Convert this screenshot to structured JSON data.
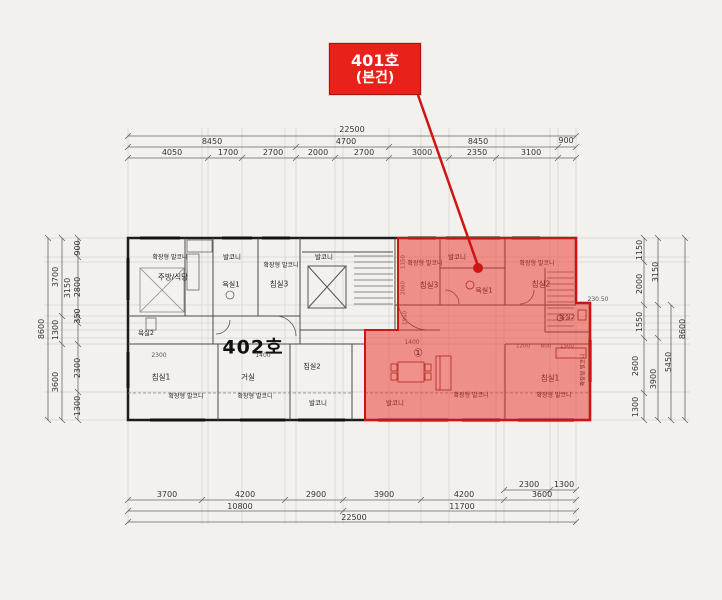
{
  "callout": {
    "line1": "401호",
    "line2": "(본건)"
  },
  "unit_label_402": "402호",
  "colors": {
    "callout_bg": "#e8211a",
    "overlay_fill": "rgba(235,45,35,0.5)",
    "overlay_stroke": "#cf1512",
    "leader_line": "#cf1512"
  },
  "dim_labels": [
    {
      "t": "22500",
      "x": 352,
      "y": 130
    },
    {
      "t": "8450",
      "x": 212,
      "y": 142
    },
    {
      "t": "4700",
      "x": 346,
      "y": 142
    },
    {
      "t": "8450",
      "x": 478,
      "y": 142
    },
    {
      "t": "900",
      "x": 566,
      "y": 141
    },
    {
      "t": "4050",
      "x": 172,
      "y": 153
    },
    {
      "t": "1700",
      "x": 228,
      "y": 153
    },
    {
      "t": "2700",
      "x": 273,
      "y": 153
    },
    {
      "t": "2000",
      "x": 318,
      "y": 153
    },
    {
      "t": "2700",
      "x": 364,
      "y": 153
    },
    {
      "t": "3000",
      "x": 422,
      "y": 153
    },
    {
      "t": "2350",
      "x": 477,
      "y": 153
    },
    {
      "t": "3100",
      "x": 531,
      "y": 153
    },
    {
      "t": "2300",
      "x": 529,
      "y": 485
    },
    {
      "t": "1300",
      "x": 564,
      "y": 485
    },
    {
      "t": "3700",
      "x": 167,
      "y": 495
    },
    {
      "t": "4200",
      "x": 245,
      "y": 495
    },
    {
      "t": "2900",
      "x": 316,
      "y": 495
    },
    {
      "t": "3900",
      "x": 384,
      "y": 495
    },
    {
      "t": "4200",
      "x": 464,
      "y": 495
    },
    {
      "t": "3600",
      "x": 542,
      "y": 495
    },
    {
      "t": "10800",
      "x": 240,
      "y": 507
    },
    {
      "t": "11700",
      "x": 462,
      "y": 507
    },
    {
      "t": "22500",
      "x": 354,
      "y": 518
    },
    {
      "t": "8600",
      "x": 42,
      "y": 329,
      "r": 1
    },
    {
      "t": "3700",
      "x": 56,
      "y": 277,
      "r": 1
    },
    {
      "t": "1300",
      "x": 56,
      "y": 330,
      "r": 1
    },
    {
      "t": "3600",
      "x": 56,
      "y": 382,
      "r": 1
    },
    {
      "t": "3150",
      "x": 68,
      "y": 288,
      "r": 1
    },
    {
      "t": "900",
      "x": 78,
      "y": 248,
      "r": 1
    },
    {
      "t": "2800",
      "x": 78,
      "y": 287,
      "r": 1
    },
    {
      "t": "350",
      "x": 78,
      "y": 316,
      "r": 1
    },
    {
      "t": "2300",
      "x": 78,
      "y": 368,
      "r": 1
    },
    {
      "t": "1300",
      "x": 78,
      "y": 406,
      "r": 1
    },
    {
      "t": "1150",
      "x": 640,
      "y": 250,
      "r": 1
    },
    {
      "t": "2000",
      "x": 640,
      "y": 284,
      "r": 1
    },
    {
      "t": "1550",
      "x": 640,
      "y": 322,
      "r": 1
    },
    {
      "t": "2600",
      "x": 636,
      "y": 366,
      "r": 1
    },
    {
      "t": "1300",
      "x": 636,
      "y": 407,
      "r": 1
    },
    {
      "t": "3150",
      "x": 656,
      "y": 272,
      "r": 1
    },
    {
      "t": "3900",
      "x": 654,
      "y": 379,
      "r": 1
    },
    {
      "t": "5450",
      "x": 669,
      "y": 362,
      "r": 1
    },
    {
      "t": "8600",
      "x": 683,
      "y": 329,
      "r": 1
    }
  ],
  "room_labels": [
    {
      "t": "확장형 발코니",
      "x": 170,
      "y": 258,
      "s": 6
    },
    {
      "t": "발코니",
      "x": 232,
      "y": 257,
      "s": 6.5
    },
    {
      "t": "주방/식당",
      "x": 173,
      "y": 277,
      "s": 7.5
    },
    {
      "t": "욕실1",
      "x": 231,
      "y": 285,
      "s": 7
    },
    {
      "t": "침실3",
      "x": 279,
      "y": 284,
      "s": 7.5
    },
    {
      "t": "확장형 발코니",
      "x": 281,
      "y": 266,
      "s": 6
    },
    {
      "t": "발코니",
      "x": 324,
      "y": 257,
      "s": 6.5
    },
    {
      "t": "욕실2",
      "x": 146,
      "y": 333,
      "s": 6.5
    },
    {
      "t": "침실1",
      "x": 161,
      "y": 377,
      "s": 7.5
    },
    {
      "t": "2300",
      "x": 159,
      "y": 356,
      "s": 6,
      "c": "#555"
    },
    {
      "t": "1400",
      "x": 263,
      "y": 356,
      "s": 6,
      "c": "#555"
    },
    {
      "t": "거실",
      "x": 248,
      "y": 377,
      "s": 7.5
    },
    {
      "t": "침실2",
      "x": 312,
      "y": 367,
      "s": 7
    },
    {
      "t": "발코니",
      "x": 318,
      "y": 403,
      "s": 6.5
    },
    {
      "t": "확장형 발코니",
      "x": 186,
      "y": 397,
      "s": 6
    },
    {
      "t": "확장형 발코니",
      "x": 255,
      "y": 397,
      "s": 6
    },
    {
      "t": "확장형 발코니",
      "x": 425,
      "y": 264,
      "s": 6
    },
    {
      "t": "침실3",
      "x": 429,
      "y": 285,
      "s": 7.5
    },
    {
      "t": "발코니",
      "x": 457,
      "y": 257,
      "s": 6.5
    },
    {
      "t": "욕실1",
      "x": 484,
      "y": 291,
      "s": 7
    },
    {
      "t": "확장형 발코니",
      "x": 537,
      "y": 264,
      "s": 6
    },
    {
      "t": "침실2",
      "x": 541,
      "y": 284,
      "s": 7.5
    },
    {
      "t": "욕실2",
      "x": 567,
      "y": 317,
      "s": 6.5
    },
    {
      "t": "침실1",
      "x": 550,
      "y": 378,
      "s": 7.5
    },
    {
      "t": "발코니",
      "x": 395,
      "y": 403,
      "s": 6.5
    },
    {
      "t": "확장형 발코니",
      "x": 471,
      "y": 396,
      "s": 6
    },
    {
      "t": "확장형 발코니",
      "x": 554,
      "y": 396,
      "s": 6
    },
    {
      "t": "확장형 발코니",
      "x": 584,
      "y": 370,
      "s": 5.5,
      "r": 1
    },
    {
      "t": "1400",
      "x": 412,
      "y": 343,
      "s": 6,
      "c": "#555"
    },
    {
      "t": "1150",
      "x": 404,
      "y": 262,
      "s": 5.5,
      "c": "#555",
      "r": 1
    },
    {
      "t": "2060",
      "x": 404,
      "y": 288,
      "s": 5.5,
      "c": "#555",
      "r": 1
    },
    {
      "t": "1950",
      "x": 406,
      "y": 318,
      "s": 5.5,
      "c": "#555",
      "r": 1
    },
    {
      "t": "1200",
      "x": 523,
      "y": 347,
      "s": 5.5,
      "c": "#555"
    },
    {
      "t": "800",
      "x": 546,
      "y": 347,
      "s": 5.5,
      "c": "#555"
    },
    {
      "t": "1500",
      "x": 567,
      "y": 347,
      "s": 5.5,
      "c": "#555"
    },
    {
      "t": "230.50",
      "x": 598,
      "y": 300,
      "s": 6,
      "c": "#555"
    },
    {
      "t": "①",
      "x": 418,
      "y": 353,
      "s": 11
    }
  ]
}
